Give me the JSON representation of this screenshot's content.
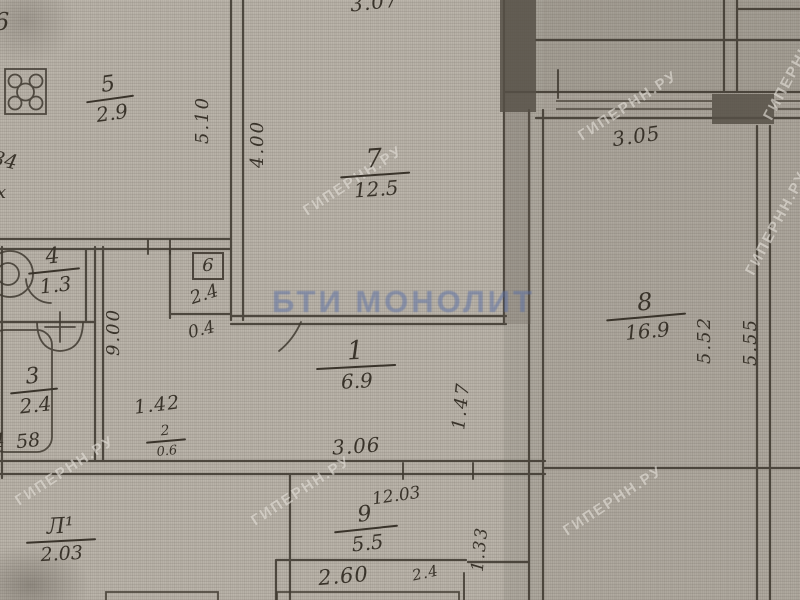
{
  "plan": {
    "title_watermark": "БТИ МОНОЛИТ",
    "site_watermark": "ГИПЕРНН.РУ",
    "rooms": [
      {
        "number": "5",
        "area": "2.9"
      },
      {
        "number": "7",
        "area": "12.5"
      },
      {
        "number": "4",
        "area": "1.3"
      },
      {
        "number": "6",
        "area": "2.4",
        "note": "0.4"
      },
      {
        "number": "3",
        "area": "2.4",
        "note": "58"
      },
      {
        "number": "1",
        "area": "6.9"
      },
      {
        "number": "8",
        "area": "16.9"
      },
      {
        "number": "9",
        "area": "5.5",
        "note": "12.03"
      },
      {
        "number": "2",
        "area": "0.6"
      },
      {
        "number": "Л¹",
        "area": "2.03"
      }
    ],
    "dimensions": {
      "top_width": "3.07",
      "room5_height": "5.10",
      "room7_height": "4.00",
      "window_width": "3.05",
      "hall_wall": "9.00",
      "hall_width": "1.42",
      "corridor_width": "3.06",
      "nook_depth": "1.47",
      "room8_height_inner": "5.52",
      "room8_height_outer": "5.55",
      "kitchen_width": "2.60",
      "kitchen_side": "2.4",
      "balcony_depth": "1.33"
    },
    "edge_fragments": {
      "top_left": "6",
      "left_upper": "34",
      "left_mid": "х",
      "left_lower": "4"
    }
  }
}
